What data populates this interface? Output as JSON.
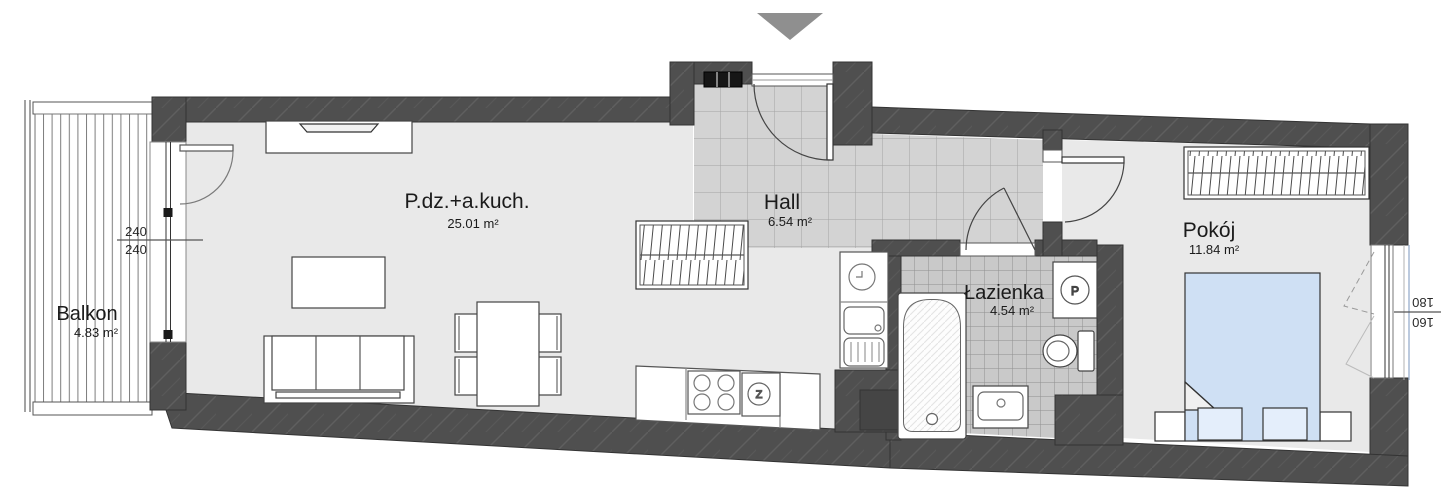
{
  "plan": {
    "type": "apartment-floor-plan",
    "entrance_marker": "entrance-arrow",
    "rooms": {
      "balkon": {
        "name": "Balkon",
        "area": "4.83 m²"
      },
      "living": {
        "name": "P.dz.+a.kuch.",
        "area": "25.01 m²"
      },
      "hall": {
        "name": "Hall",
        "area": "6.54 m²"
      },
      "lazienka": {
        "name": "Łazienka",
        "area": "4.54 m²"
      },
      "pokoj": {
        "name": "Pokój",
        "area": "11.84 m²"
      }
    },
    "dimensions": {
      "balcony_door": {
        "top": "240",
        "bottom": "240"
      },
      "bedroom_window": {
        "top": "180",
        "bottom": "160"
      }
    },
    "symbols": {
      "kitchen_sink": "Z",
      "washing_machine": "P"
    },
    "colors": {
      "wall": "#4f4f4f",
      "wall_hatch": "#5f5f5f",
      "floor": "#e9e9e9",
      "hall_tile": "#d3d3d3",
      "hall_grid": "#a3a3a3",
      "bath_tile": "#c9c9c9",
      "bath_grid": "#8f8f8f",
      "bed": "#cfe0f4",
      "pillow": "#e4eefb",
      "arrow": "#8f8f8f",
      "text": "#1b1b1b"
    }
  }
}
